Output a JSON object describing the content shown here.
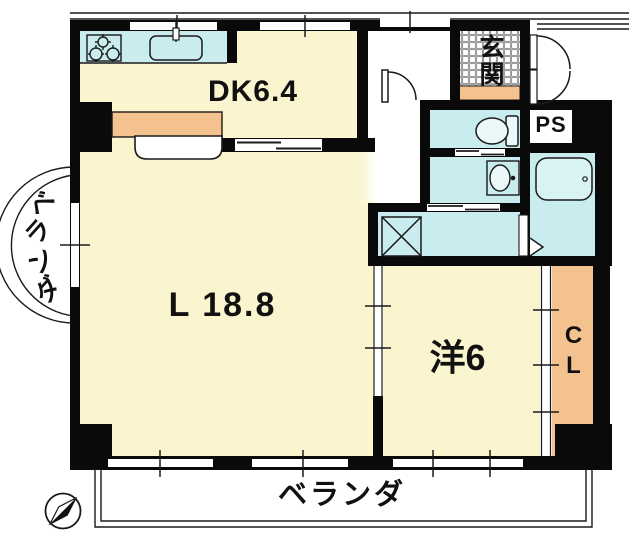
{
  "title": "apartment-floor-plan",
  "rooms": {
    "dk": {
      "label": "DK6.4"
    },
    "living": {
      "label": "L 18.8"
    },
    "western": {
      "label": "洋6"
    },
    "genkan": {
      "label": "玄関"
    },
    "ps": {
      "label": "PS"
    },
    "closet": {
      "label": "CL"
    },
    "veranda_bottom": {
      "label": "ベランダ"
    },
    "veranda_left": {
      "chars": [
        "ベ",
        "ラ",
        "ン",
        "ダ"
      ]
    }
  },
  "fixtures": [
    "stove-icon",
    "sink-icon",
    "toilet-icon",
    "washbasin-icon",
    "bathtub-icon",
    "washer-pan-icon",
    "compass-icon"
  ],
  "colors": {
    "room-yellow": "#FAF5CF",
    "wet-cyan": "#C9ECEF",
    "counter-orange": "#F4C28F",
    "wall-black": "#0A0A0A",
    "line-black": "#1A1A1A",
    "tile-grey": "#8A8A8A"
  }
}
